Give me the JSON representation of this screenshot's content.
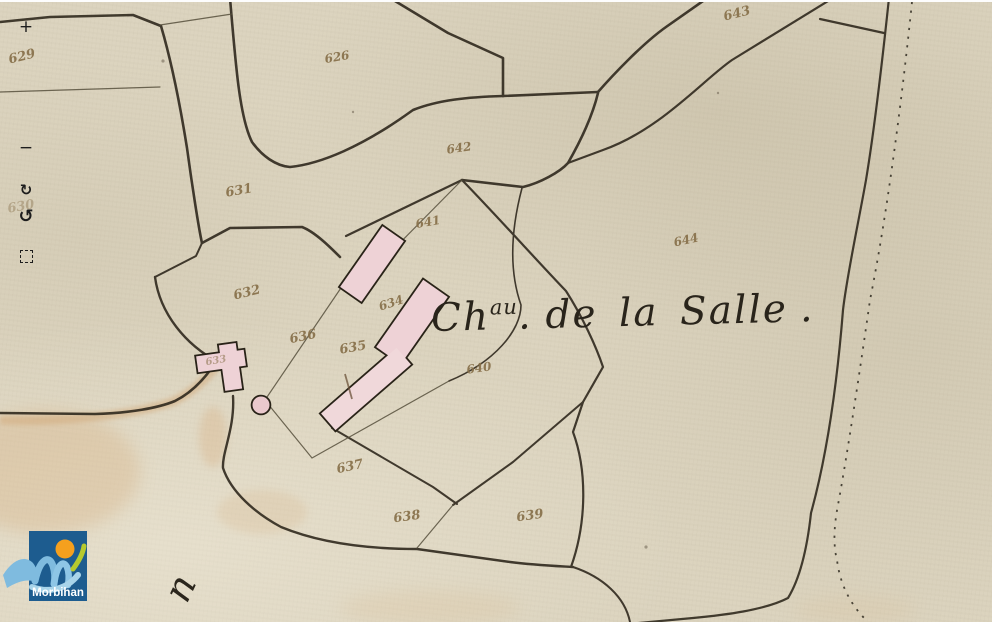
{
  "map": {
    "title": {
      "ch": "Ch",
      "sup": "au",
      "dot": ".",
      "rest": "de la Salle",
      "enddot": "."
    },
    "road_letter": "n",
    "parcels": [
      {
        "label": "629",
        "x": 22,
        "y": 57,
        "r": -14
      },
      {
        "label": "626",
        "x": 337,
        "y": 57,
        "r": -10,
        "s": 12
      },
      {
        "label": "643",
        "x": 737,
        "y": 14,
        "r": -14
      },
      {
        "label": "642",
        "x": 459,
        "y": 148,
        "r": -8,
        "s": 12
      },
      {
        "label": "631",
        "x": 239,
        "y": 191,
        "r": -10
      },
      {
        "label": "630",
        "x": 21,
        "y": 207,
        "r": -10,
        "o": 0.42
      },
      {
        "label": "641",
        "x": 428,
        "y": 222,
        "r": -10,
        "s": 12
      },
      {
        "label": "644",
        "x": 686,
        "y": 240,
        "r": -12,
        "s": 12
      },
      {
        "label": "632",
        "x": 247,
        "y": 293,
        "r": -14
      },
      {
        "label": "634",
        "x": 391,
        "y": 303,
        "r": -18,
        "s": 12
      },
      {
        "label": "636",
        "x": 303,
        "y": 337,
        "r": -12
      },
      {
        "label": "635",
        "x": 353,
        "y": 348,
        "r": -10
      },
      {
        "label": "633",
        "x": 216,
        "y": 361,
        "r": -10,
        "o": 0.55,
        "s": 10
      },
      {
        "label": "640",
        "x": 479,
        "y": 368,
        "r": -8,
        "s": 12
      },
      {
        "label": "637",
        "x": 350,
        "y": 467,
        "r": -12
      },
      {
        "label": "638",
        "x": 407,
        "y": 517,
        "r": -8
      },
      {
        "label": "639",
        "x": 530,
        "y": 516,
        "r": -8
      }
    ],
    "colors": {
      "paper": "#dcd4bf",
      "ink_line": "#332c21",
      "building_fill": "#eed2d6",
      "ink_number": "#87704a",
      "road_wash": "#d8b487"
    }
  },
  "controls": {
    "zoom_in_glyph": "+",
    "zoom_out_glyph": "−",
    "rotate_cw_glyph": "↻",
    "rotate_ccw_glyph": "↺"
  },
  "logo": {
    "text": "Morbihan",
    "blue": "#1d5c8f",
    "orange": "#f5a01e",
    "green": "#b6ca2f",
    "wave": "#7fbbdf"
  }
}
